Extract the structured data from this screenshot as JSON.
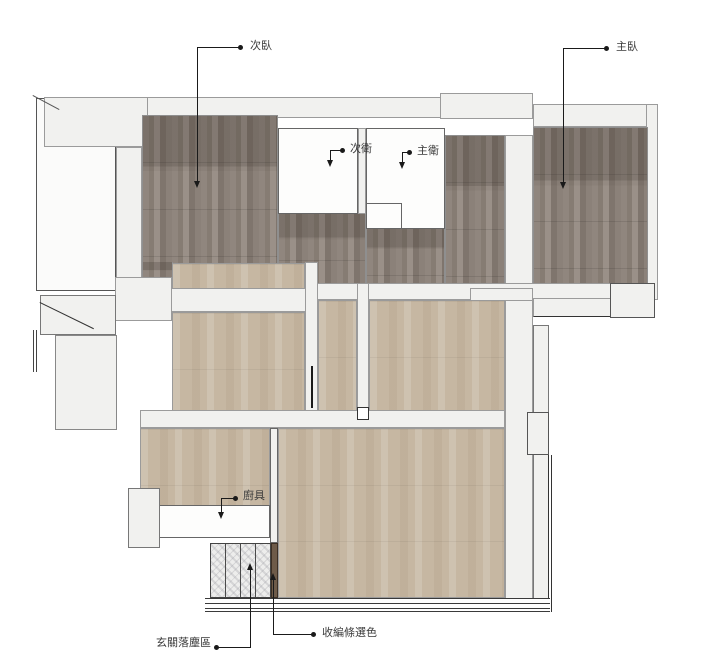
{
  "plan": {
    "title": "apartment-floor-plan",
    "labels": {
      "secondary_bedroom": "次臥",
      "master_bedroom": "主臥",
      "secondary_bathroom": "次衛",
      "master_bathroom": "主衛",
      "kitchen_unit": "廚具",
      "entry_dust_zone": "玄關落塵區",
      "edge_trim_color_selection": "收編條選色"
    },
    "colors": {
      "wall_fill": "#f1f1ef",
      "wood_dark": "#867c74",
      "floor_beige": "#c6b7a2",
      "tile_fill": "#ededec",
      "trim_brown": "#6e5b49",
      "label_text": "#3a3a3a"
    }
  }
}
